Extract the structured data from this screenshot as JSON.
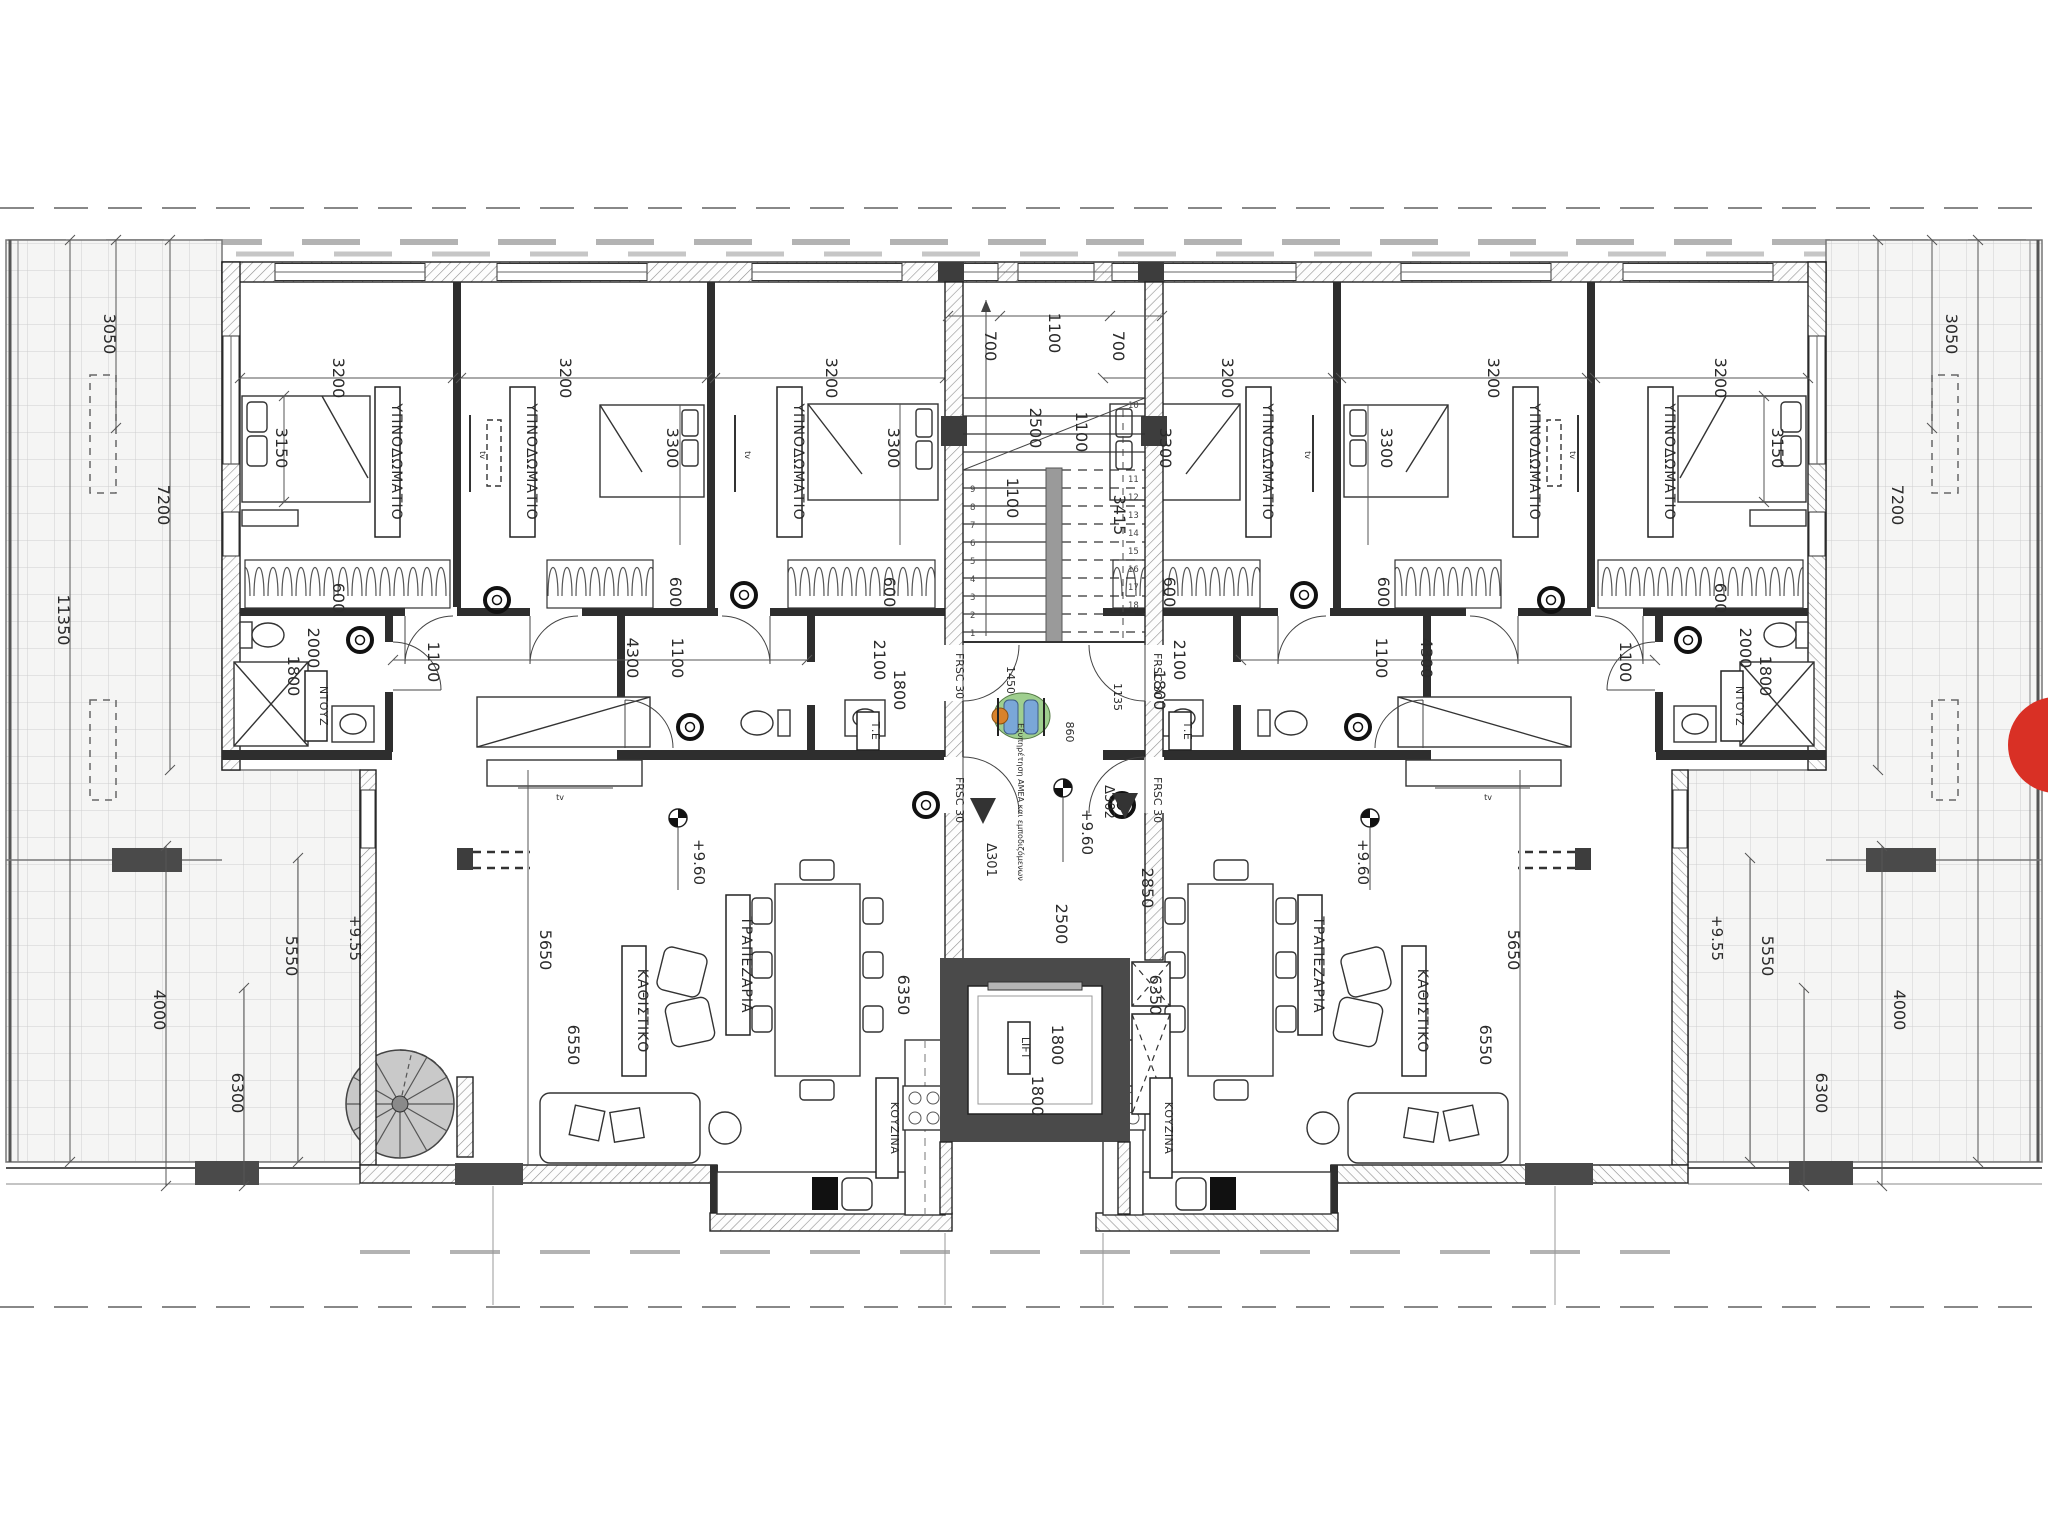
{
  "rooms": {
    "bedroom": "ΥΠΝΟΔΩΜΑΤΙΟ",
    "living": "ΚΑΘΙΣΤΙΚΟ",
    "dining": "ΤΡΑΠΕΖΑΡΙΑ",
    "kitchen": "ΚΟΥΖΙΝΑ",
    "shower": "ΝΤΟΥΖ",
    "te": "Τ.Ε",
    "lift": "LIFT",
    "tv": "tv"
  },
  "doors": {
    "d301": "Δ301",
    "d302": "Δ302",
    "fire": "FRSC 30"
  },
  "levels": {
    "floor": "+9.60",
    "terrace": "+9.55"
  },
  "notes": {
    "amea": "Εξυπηρέτηση ΑΜΕΑ και εμποδιζόμενων"
  },
  "dims": {
    "d700": "700",
    "d1100": "1100",
    "d2500": "2500",
    "d3415": "3415",
    "d1450": "1450",
    "d860": "860",
    "d1135": "1135",
    "d2850": "2850",
    "d3200": "3200",
    "d3150": "3150",
    "d3300": "3300",
    "d600": "600",
    "d4300": "4300",
    "d2100": "2100",
    "d1800": "1800",
    "d2000": "2000",
    "d5650": "5650",
    "d6550": "6550",
    "d6350": "6350",
    "d3050": "3050",
    "d7200": "7200",
    "d11350": "11350",
    "d5550": "5550",
    "d4000": "4000",
    "d6300": "6300"
  },
  "steps": [
    "1",
    "2",
    "3",
    "4",
    "5",
    "6",
    "7",
    "8",
    "9",
    "10",
    "11",
    "12",
    "13",
    "14",
    "15",
    "16",
    "17",
    "18"
  ]
}
